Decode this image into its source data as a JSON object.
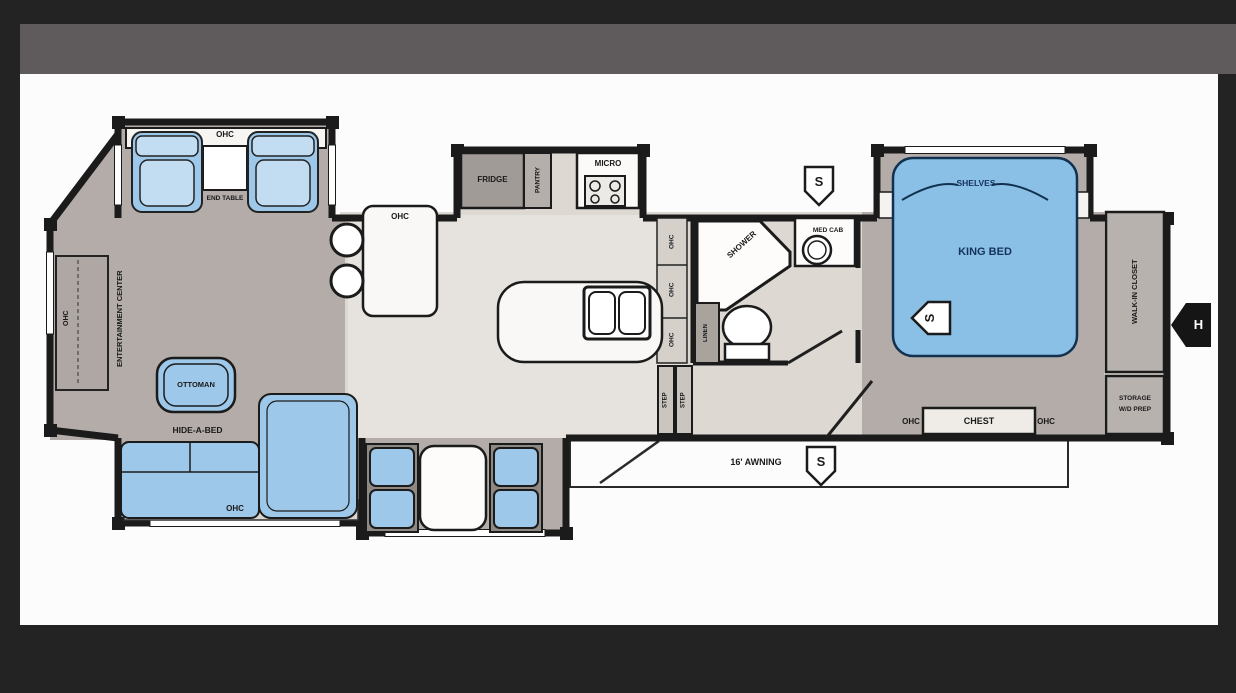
{
  "plan": {
    "living": {
      "lounge_ohc": "OHC",
      "end_table": "END TABLE",
      "front_ohc": "OHC",
      "entertainment_center": "ENTERTAINMENT CENTER",
      "ottoman": "OTTOMAN",
      "hide_a_bed": "HIDE-A-BED",
      "sofa_ohc": "OHC"
    },
    "kitchen": {
      "counter_ohc": "OHC",
      "fridge": "FRIDGE",
      "pantry": "PANTRY",
      "micro": "MICRO",
      "wall_ohc_upper": "OHC",
      "wall_ohc_mid": "OHC",
      "wall_ohc_lower": "OHC"
    },
    "entry": {
      "step_left": "STEP",
      "step_right": "STEP",
      "awning": "16' AWNING"
    },
    "bath": {
      "shower": "SHOWER",
      "med_cab": "MED CAB",
      "linen": "LINEN"
    },
    "bedroom": {
      "shelves": "SHELVES",
      "king_bed": "KING BED",
      "ohc_left": "OHC",
      "chest": "CHEST",
      "ohc_right": "OHC",
      "walk_in_closet": "WALK-IN CLOSET",
      "storage_line1": "STORAGE",
      "storage_line2": "W/D PREP"
    },
    "icons": {
      "speaker_bath": "S",
      "speaker_bed": "S",
      "speaker_awning": "S",
      "water_heater": "H"
    }
  },
  "colors": {
    "page_bg": "#232323",
    "band": "#5f5b5c",
    "canvas": "#fcfcfc",
    "wall": "#1b1b1b",
    "floor_taupe": "#b3aca8",
    "floor_light": "#ddd8d2",
    "lino_light": "#e6e2dd",
    "furniture_blue": "#9ec8e9",
    "bed_blue": "#8ac0e6",
    "cabinet_gray": "#a9a39e",
    "label_navy": "#15325d"
  }
}
